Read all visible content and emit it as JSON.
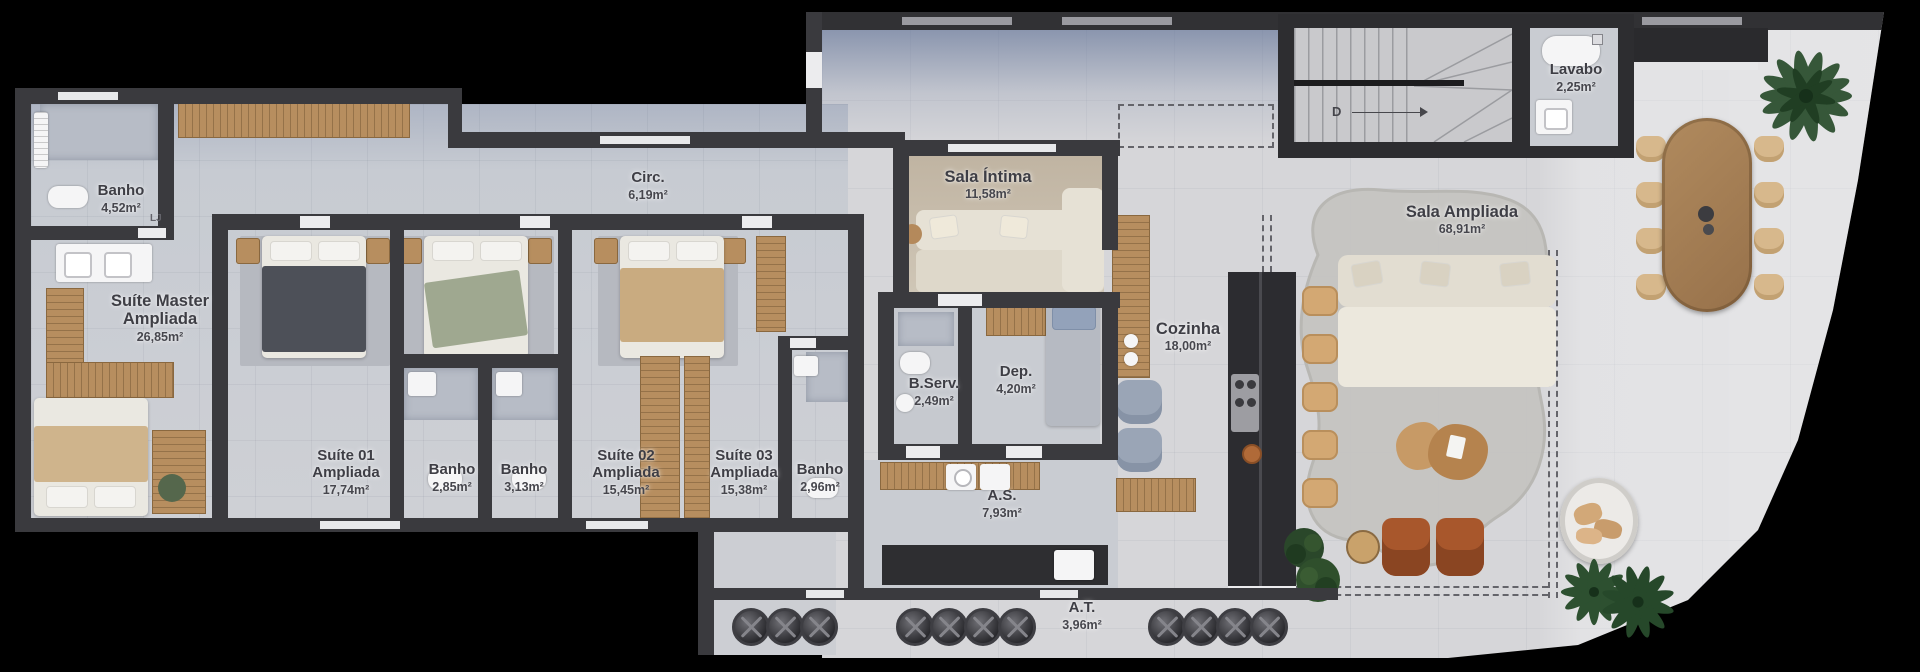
{
  "plan": {
    "type": "apartment-floor-plan",
    "language": "pt-BR"
  },
  "rooms": [
    {
      "id": "banho-master",
      "name": "Banho",
      "area": "4,52m²"
    },
    {
      "id": "suite-master",
      "name": "Suíte Master Ampliada",
      "area": "26,85m²"
    },
    {
      "id": "circ",
      "name": "Circ.",
      "area": "6,19m²"
    },
    {
      "id": "sala-intima",
      "name": "Sala Íntima",
      "area": "11,58m²"
    },
    {
      "id": "lavabo",
      "name": "Lavabo",
      "area": "2,25m²"
    },
    {
      "id": "sala-ampliada",
      "name": "Sala Ampliada",
      "area": "68,91m²"
    },
    {
      "id": "cozinha",
      "name": "Cozinha",
      "area": "18,00m²"
    },
    {
      "id": "b-serv",
      "name": "B.Serv.",
      "area": "2,49m²"
    },
    {
      "id": "dep",
      "name": "Dep.",
      "area": "4,20m²"
    },
    {
      "id": "suite-01",
      "name": "Suíte 01 Ampliada",
      "area": "17,74m²"
    },
    {
      "id": "banho-01",
      "name": "Banho",
      "area": "2,85m²"
    },
    {
      "id": "banho-02",
      "name": "Banho",
      "area": "3,13m²"
    },
    {
      "id": "suite-02",
      "name": "Suíte 02 Ampliada",
      "area": "15,45m²"
    },
    {
      "id": "suite-03",
      "name": "Suíte 03 Ampliada",
      "area": "15,38m²"
    },
    {
      "id": "banho-03",
      "name": "Banho",
      "area": "2,96m²"
    },
    {
      "id": "as",
      "name": "A.S.",
      "area": "7,93m²"
    },
    {
      "id": "at",
      "name": "A.T.",
      "area": "3,96m²"
    }
  ],
  "stairs": {
    "direction_label": "D"
  },
  "marks": {
    "door_mark": "LJ"
  },
  "palette": {
    "background": "#000000",
    "wall": "#3a3a3e",
    "floor_private": "#c9cdd4",
    "floor_social": "#d6d6d9",
    "wood": "#b78e5f",
    "leather": "#a8572c",
    "plant": "#2d5030"
  }
}
